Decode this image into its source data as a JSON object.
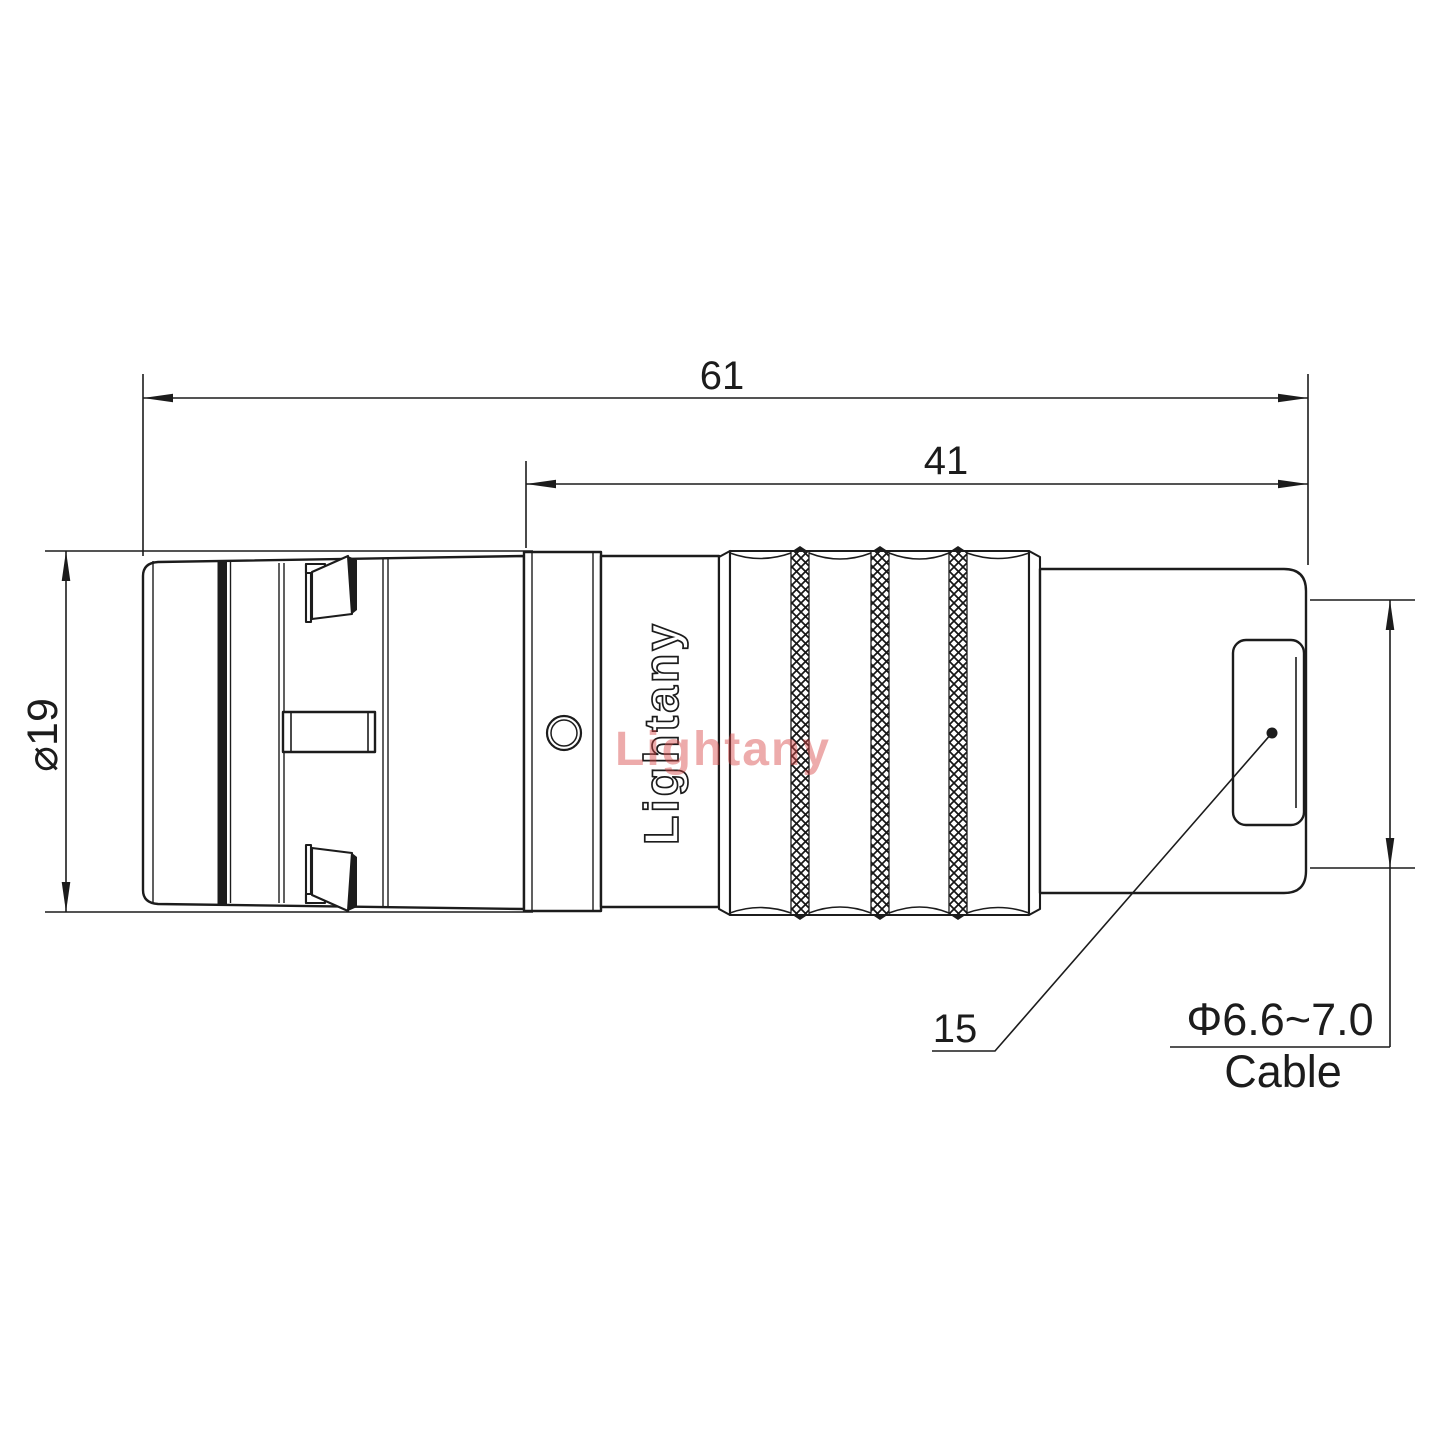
{
  "drawing": {
    "type": "connector-dimension-drawing",
    "background_color": "#ffffff",
    "line_color": "#1c1c1c",
    "watermark_color": "rgba(214,68,68,0.45)",
    "dimensions": {
      "overall_length": "61",
      "body_length": "41",
      "shell_diameter": "⌀19",
      "item_number": "15",
      "cable_range": "Φ6.6~7.0",
      "cable_label": "Cable"
    },
    "branding": {
      "engraving": "Lightany",
      "watermark": "Lightany"
    }
  }
}
